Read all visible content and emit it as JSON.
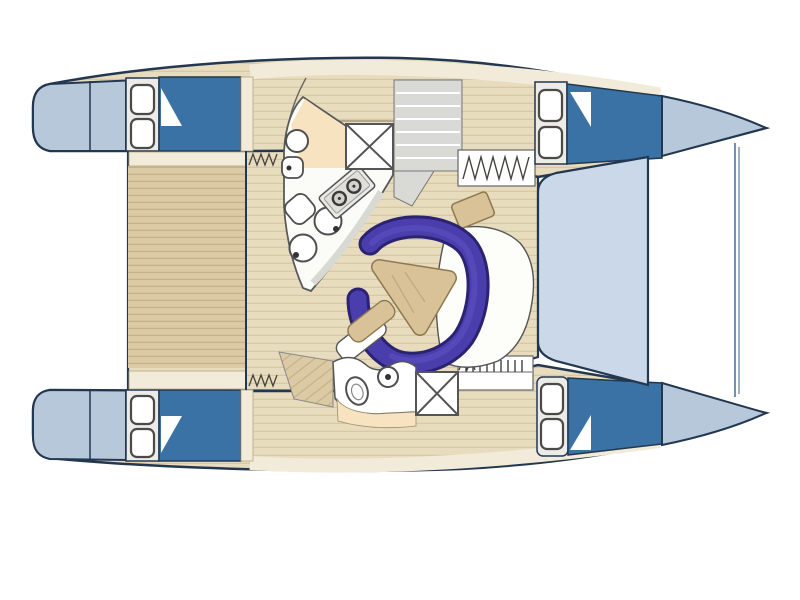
{
  "diagram": {
    "subject": "catamaran-deck-and-interior-layout-plan",
    "view": "top-down",
    "bow_direction": "right",
    "hull_count": 2,
    "visible_text": ""
  },
  "colors": {
    "background": "#ffffff",
    "outline": "#233750",
    "hull_tip_blue": "#b7c8db",
    "cabin_blue": "#3a72a6",
    "foredeck_blue": "#cad8e9",
    "deck_plank_base": "#dccaa4",
    "deck_plank_line": "#c6b189",
    "salon_plank_base": "#e8dcbe",
    "salon_plank_line": "#d8c8a4",
    "cream_trim": "#f2ebd9",
    "cream_edge": "#b0a584",
    "counter_white": "#fbfbf7",
    "counter_shadow": "#d9d9d3",
    "counter_beige": "#f7e3bf",
    "panel_grey": "#d9d9d5",
    "panel_line": "#777777",
    "hatch_white": "#ffffff",
    "hatch_stroke": "#4a4a48",
    "fixture_stroke": "#4f4f4f",
    "fixture_inner": "#888888",
    "fixture_dot": "#333333",
    "stove_body": "#eceae6",
    "stove_inner": "#e0dfda",
    "burner_ring": "#3a3a3a",
    "burner_fill": "#d2d1cc",
    "settee_blue": "#4a3ead",
    "settee_edge": "#2b2371",
    "settee_highlight": "#5b4ec0",
    "table_wood": "#d9c297",
    "table_edge": "#8d794f",
    "table_grain": "#c4ab7d",
    "trampoline_line": "#6e92b5",
    "mark_stroke": "#44423e",
    "wall_grey": "#666666",
    "berth_line": "#a3947a"
  },
  "parts": [
    "hull-port",
    "hull-starboard",
    "stern-platform-port",
    "stern-platform-starboard",
    "bow-port",
    "bow-starboard",
    "cockpit-deck",
    "bridge-deck",
    "foredeck",
    "trampoline-forestay",
    "aft-cabin-roof-port",
    "aft-cabin-roof-starboard",
    "fwd-cabin-roof-port",
    "fwd-cabin-roof-starboard",
    "deck-hatch",
    "companionway-steps",
    "galley-counter",
    "galley-worktop",
    "stove",
    "galley-sink",
    "washbasin",
    "toilet",
    "galley-cabinet",
    "hatch-table",
    "settee",
    "settee-backrest",
    "salon-table",
    "nav-seat",
    "helm-seat",
    "aft-head",
    "cockpit-steps",
    "berth"
  ]
}
